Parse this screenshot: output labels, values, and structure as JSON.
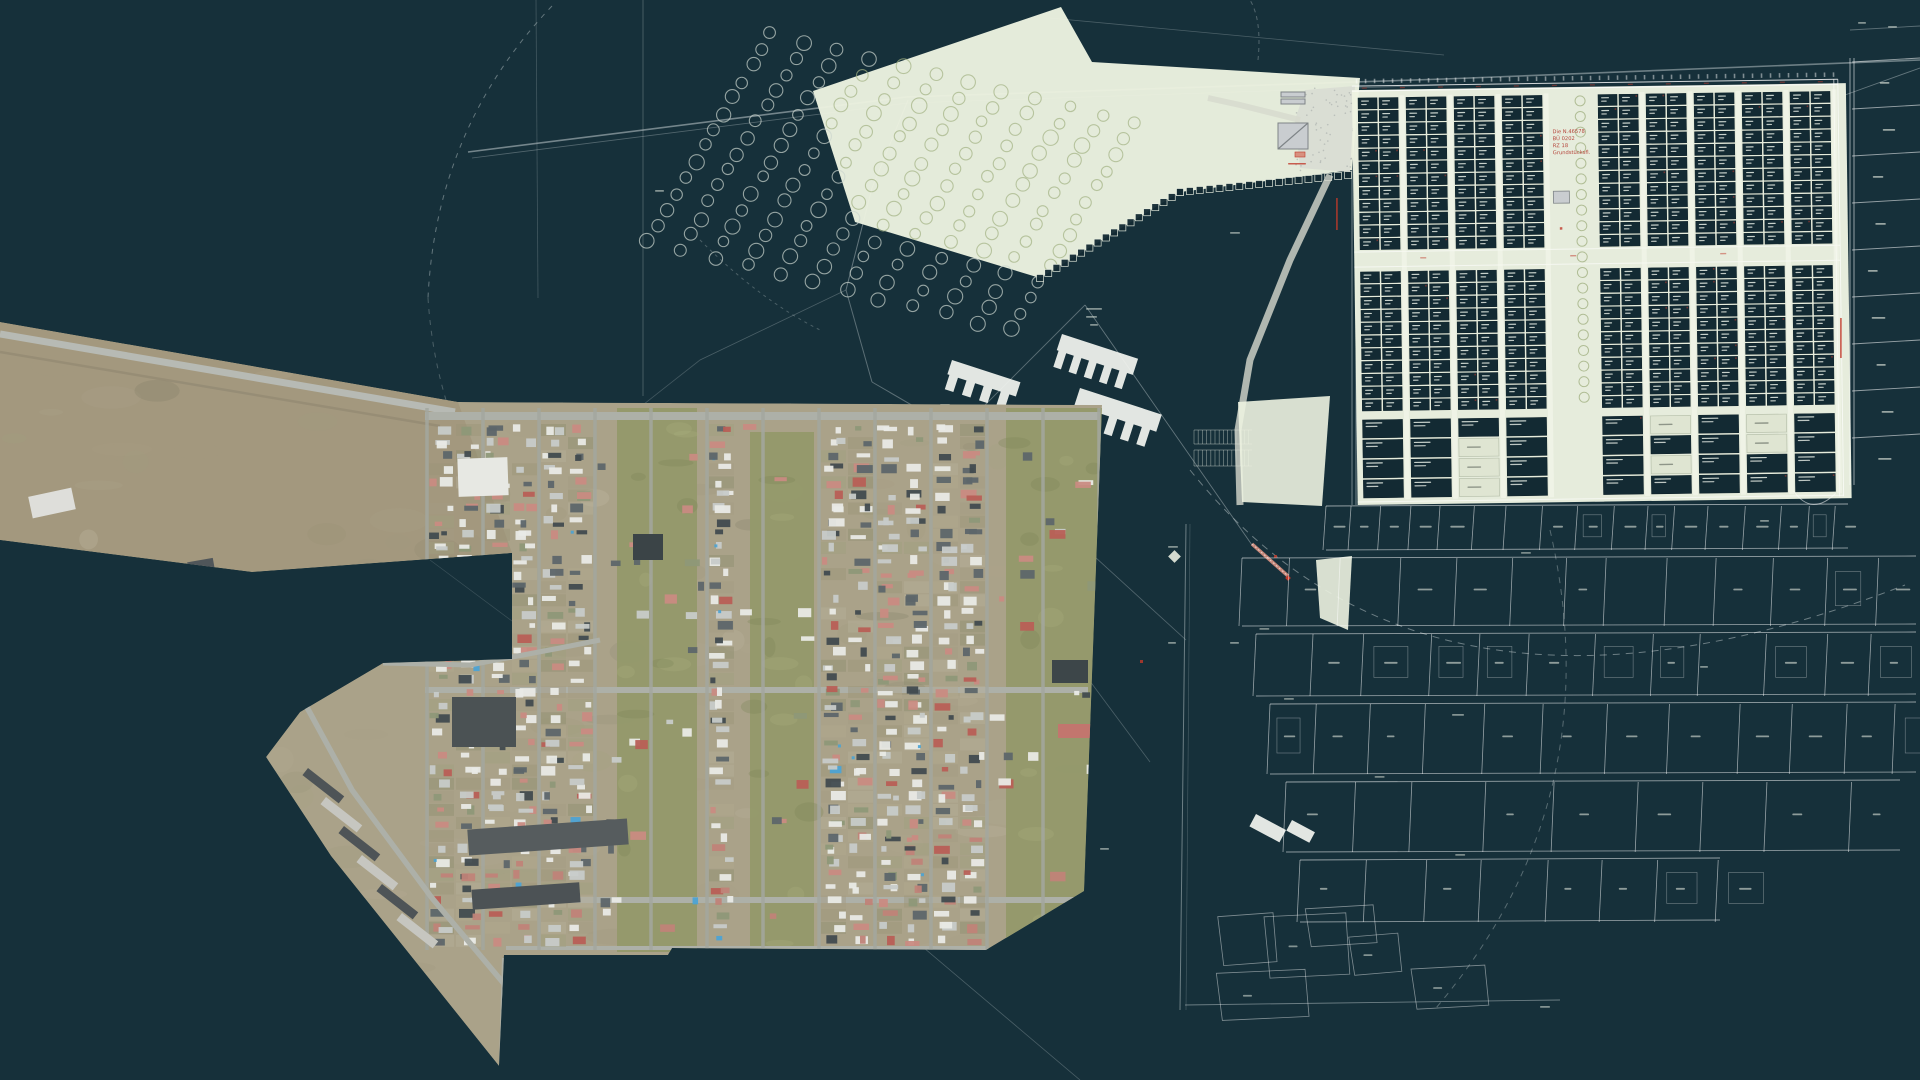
{
  "canvas": {
    "width": 1920,
    "height": 1080,
    "background": "#16303a"
  },
  "rng_seed": 1337,
  "orthophoto": {
    "outline": [
      [
        0,
        322
      ],
      [
        458,
        402
      ],
      [
        1102,
        405
      ],
      [
        1084,
        891
      ],
      [
        986,
        950
      ],
      [
        672,
        948
      ],
      [
        668,
        955
      ],
      [
        540,
        955
      ],
      [
        504,
        955
      ],
      [
        499,
        1066
      ],
      [
        331,
        856
      ],
      [
        266,
        757
      ],
      [
        300,
        712
      ],
      [
        383,
        663
      ],
      [
        512,
        659
      ],
      [
        512,
        553
      ],
      [
        252,
        572
      ],
      [
        0,
        540
      ]
    ],
    "strip": [
      [
        0,
        322
      ],
      [
        458,
        402
      ],
      [
        512,
        553
      ],
      [
        252,
        572
      ],
      [
        0,
        540
      ]
    ],
    "base_color": "#aaa289",
    "strip_color": "#a3987e",
    "ground_tints": [
      "#a59c82",
      "#b1a88f",
      "#9b9478",
      "#8f8e6e",
      "#b6af99",
      "#a0a07f"
    ],
    "mottle_dark": "#6f6d58",
    "mottle_light": "#cfc9b2",
    "green_color": "#93996a",
    "green_dark": "#7c8355",
    "green_bands": [
      [
        617,
        408,
        80,
        544
      ],
      [
        750,
        432,
        64,
        520
      ],
      [
        1006,
        408,
        96,
        544
      ]
    ],
    "road_color": "#adb0a8",
    "roads_h": [
      [
        425,
        416,
        1100,
        416,
        8
      ],
      [
        425,
        690,
        1088,
        690,
        6
      ],
      [
        470,
        900,
        1082,
        900,
        6
      ],
      [
        506,
        948,
        986,
        948,
        4
      ]
    ],
    "strip_road": [
      [
        0,
        334,
        455,
        412,
        7
      ],
      [
        0,
        352,
        440,
        426,
        2.5
      ]
    ],
    "lanes": {
      "x0": 427,
      "step": 56,
      "count": 13,
      "y0": 408,
      "y1": 950,
      "w": 3.5,
      "color": "#a4a79f"
    },
    "shed_palette": [
      [
        "#e9eae6",
        26
      ],
      [
        "#c7cbc9",
        18
      ],
      [
        "#5d666a",
        16
      ],
      [
        "#414b4f",
        10
      ],
      [
        "#c98b82",
        12
      ],
      [
        "#b85f56",
        5
      ],
      [
        "#8e9878",
        6
      ],
      [
        "#4da3d4",
        2
      ],
      [
        "none",
        5
      ]
    ],
    "accent_blue": "#4aa3d4",
    "red_boost": "#c08378",
    "buildings": [
      [
        458,
        458,
        50,
        38,
        "#e7e8e3",
        -2
      ],
      [
        452,
        697,
        64,
        50,
        "#4b5254",
        0
      ],
      [
        633,
        534,
        30,
        26,
        "#3b4447",
        0
      ],
      [
        1052,
        660,
        36,
        23,
        "#3d4649",
        0
      ],
      [
        468,
        824,
        160,
        26,
        "#565c5e",
        -4
      ],
      [
        472,
        886,
        108,
        20,
        "#4c5255",
        -4
      ],
      [
        1058,
        724,
        34,
        14,
        "#c2766e",
        0
      ],
      [
        30,
        492,
        44,
        22,
        "#dededa",
        -12
      ],
      [
        188,
        560,
        26,
        12,
        "#50565a",
        -10
      ]
    ],
    "arm_road": [
      [
        303,
        700
      ],
      [
        352,
        790
      ],
      [
        432,
        898
      ],
      [
        505,
        985
      ],
      [
        503,
        1060
      ]
    ],
    "connector_road": [
      [
        383,
        663
      ],
      [
        470,
        665
      ],
      [
        560,
        648
      ],
      [
        600,
        640
      ]
    ],
    "wedge_road": [
      [
        504,
        958
      ],
      [
        501,
        1064
      ]
    ],
    "garages": {
      "rows": [
        [
          308,
          768
        ],
        [
          326,
          797
        ],
        [
          344,
          826
        ],
        [
          362,
          855
        ],
        [
          382,
          884
        ],
        [
          402,
          913
        ]
      ],
      "w": 46,
      "h": 9,
      "rot": 38,
      "colors": [
        "#4e5457",
        "#c6c6c0"
      ]
    }
  },
  "plan": {
    "line_color": "#c2ccce",
    "pale_color": "#edf3e1",
    "cell_color": "#132a33",
    "cell_stroke": "#0c1f27",
    "cell_label_color": "#e8eee6",
    "gray_building": "#c9cdd0",
    "gray_building_stroke": "#7e8487",
    "road_fill": "#d7dace",
    "red": "#c0392b",
    "red_soft": "#d8907f",
    "white_fill": "#f2f4ef",
    "label_white": "#dfe5da",
    "tree_stroke_dark": "#ccd5cf",
    "tree_stroke_pale": "#a2b283",
    "faint_lines": [
      [
        468,
        152,
        906,
        97,
        1.6,
        0.55
      ],
      [
        472,
        158,
        908,
        103,
        0.8,
        0.35
      ],
      [
        906,
        97,
        1444,
        79,
        1.6,
        0.5
      ],
      [
        1444,
        79,
        1920,
        60,
        1.6,
        0.5
      ],
      [
        908,
        103,
        1444,
        85,
        0.8,
        0.3
      ],
      [
        643,
        0,
        643,
        396,
        0.8,
        0.35
      ],
      [
        536,
        0,
        538,
        298,
        0.8,
        0.25
      ],
      [
        908,
        100,
        872,
        188,
        1,
        0.45
      ],
      [
        872,
        188,
        846,
        290,
        1,
        0.45
      ],
      [
        846,
        290,
        872,
        382,
        1,
        0.4
      ],
      [
        872,
        382,
        958,
        432,
        1,
        0.4
      ],
      [
        846,
        290,
        700,
        360,
        0.8,
        0.3
      ],
      [
        700,
        360,
        560,
        470,
        0.8,
        0.25
      ],
      [
        958,
        432,
        1085,
        305,
        0.9,
        0.4
      ],
      [
        1085,
        305,
        1252,
        545,
        0.9,
        0.45
      ],
      [
        958,
        432,
        1186,
        640,
        0.8,
        0.35
      ],
      [
        905,
        432,
        1150,
        762,
        0.8,
        0.3
      ],
      [
        560,
        640,
        1080,
        1080,
        0.8,
        0.3
      ],
      [
        620,
        598,
        764,
        878,
        0.7,
        0.25
      ],
      [
        430,
        560,
        618,
        700,
        0.7,
        0.2
      ],
      [
        1050,
        18,
        1444,
        55,
        0.8,
        0.3
      ],
      [
        1850,
        30,
        1920,
        26,
        0.9,
        0.4
      ],
      [
        1845,
        95,
        1920,
        68,
        0.9,
        0.45
      ],
      [
        1186,
        524,
        1180,
        1010,
        1,
        0.5
      ],
      [
        1190,
        524,
        1186,
        1010,
        0.6,
        0.3
      ],
      [
        1352,
        88,
        1352,
        505,
        0.9,
        0.6
      ],
      [
        1356,
        88,
        1356,
        505,
        0.9,
        0.6
      ],
      [
        1185,
        1005,
        1560,
        1000,
        0.9,
        0.5
      ]
    ],
    "dashed_paths": [
      [
        "M552,6 Q436,128 428,298",
        0.45,
        "5 6"
      ],
      [
        "M428,298 Q436,420 500,512",
        0.3,
        "5 6"
      ],
      [
        "M1190,470 Q1430,770 1905,585",
        0.5,
        "7 6"
      ],
      [
        "M1550,530 Q1612,800 1436,1008",
        0.38,
        "6 6"
      ],
      [
        "M700,240 Q760,300 820,330",
        0.3,
        "3 4"
      ],
      [
        "M1258,60 Q1262,20 1250,0",
        0.35,
        "4 4"
      ]
    ],
    "orchard": [
      [
        813,
        91
      ],
      [
        1061,
        7
      ],
      [
        1092,
        62
      ],
      [
        1360,
        78
      ],
      [
        1352,
        170
      ],
      [
        1180,
        192
      ],
      [
        1040,
        278
      ],
      [
        855,
        222
      ]
    ],
    "tree_rows": {
      "count": 12,
      "sx": 648,
      "sy": 242,
      "row_dx": 33,
      "row_dy": 8,
      "step_dx": 9.5,
      "step_dy": -16,
      "steps": 14,
      "r": 6.5
    },
    "hedge_row": {
      "path": [
        [
          1040,
          278
        ],
        [
          1180,
          192
        ],
        [
          1348,
          175
        ]
      ],
      "size": 7,
      "step": 9.5
    },
    "plaza": {
      "poly": [
        [
          1305,
          90
        ],
        [
          1355,
          86
        ],
        [
          1350,
          172
        ],
        [
          1300,
          168
        ],
        [
          1295,
          120
        ]
      ],
      "walk": [
        [
          1300,
          120
        ],
        [
          1240,
          105
        ],
        [
          1208,
          98
        ]
      ],
      "buildings": [
        [
          1278,
          123,
          30,
          26
        ],
        [
          1281,
          92,
          24,
          5
        ],
        [
          1281,
          99,
          24,
          5
        ]
      ],
      "red_rect": [
        1295,
        152,
        10,
        5
      ],
      "red_label": [
        1288,
        163,
        18
      ],
      "access_road": [
        [
          1330,
          175
        ],
        [
          1290,
          260
        ],
        [
          1250,
          360
        ],
        [
          1238,
          430
        ],
        [
          1240,
          505
        ]
      ]
    },
    "grid": {
      "x0": 1358,
      "y0": 98,
      "groups": 10,
      "group_w": 48,
      "cell_w": 19,
      "cell_h": 11,
      "gap": 2,
      "row_step": 12.8,
      "upper_rows": 12,
      "mid_y": 252,
      "lower_y": 272,
      "lower_rows": 11,
      "bottom_y": 420,
      "bottom_rows": 4,
      "bottom_h": 20,
      "corridor_group": 4,
      "rot": -0.8,
      "bg_x": 1352,
      "bg_y": 90,
      "bg_w": 494,
      "bg_h": 415,
      "annotation": [
        "Die N.46578",
        "BÜ 0202",
        "RZ 18",
        "Grundstücksfl."
      ],
      "annotation_color": "#b5443a"
    },
    "red_vlabels": [
      [
        1336,
        198,
        32
      ],
      [
        1840,
        318,
        40
      ]
    ],
    "red_dots": [
      [
        1274,
        555
      ],
      [
        1140,
        660
      ]
    ],
    "right_parcels": {
      "x0": 1852,
      "x1": 1920,
      "y0": 62,
      "rows": 9,
      "h": 47
    },
    "lower_bands": [
      [
        506,
        44,
        1326,
        1848,
        17
      ],
      [
        558,
        68,
        1242,
        1916,
        13
      ],
      [
        634,
        62,
        1256,
        1916,
        12
      ],
      [
        704,
        70,
        1270,
        1916,
        11
      ],
      [
        782,
        70,
        1286,
        1900,
        9
      ],
      [
        860,
        62,
        1300,
        1720,
        6
      ]
    ],
    "white_buildings": [
      [
        1062,
        334,
        80,
        34,
        5,
        18
      ],
      [
        1080,
        388,
        86,
        36,
        5,
        18
      ],
      [
        952,
        360,
        72,
        30,
        4,
        18
      ],
      [
        1256,
        814,
        34,
        14,
        0,
        28
      ],
      [
        1292,
        820,
        26,
        12,
        0,
        28
      ]
    ],
    "pale_patches": [
      [
        [
          1238,
          402
        ],
        [
          1330,
          396
        ],
        [
          1322,
          506
        ],
        [
          1242,
          502
        ]
      ],
      [
        [
          1316,
          560
        ],
        [
          1352,
          556
        ],
        [
          1348,
          630
        ],
        [
          1320,
          618
        ]
      ]
    ],
    "parking": {
      "x0": 1194,
      "x1": 1252,
      "rows": [
        [
          430,
          444
        ],
        [
          450,
          466
        ]
      ]
    },
    "pink_bar": [
      1252,
      544,
      1288,
      576
    ],
    "white_diamond": [
      1170,
      552,
      9
    ],
    "labels": [
      [
        1086,
        308,
        16
      ],
      [
        1086,
        316,
        11
      ],
      [
        1090,
        324,
        8
      ],
      [
        940,
        404,
        10
      ],
      [
        1046,
        468,
        9
      ],
      [
        1168,
        546,
        10
      ],
      [
        1230,
        642,
        9
      ],
      [
        1168,
        642,
        8
      ],
      [
        1452,
        714,
        12
      ],
      [
        1540,
        1006,
        10
      ],
      [
        1100,
        848,
        9
      ],
      [
        655,
        190,
        9
      ],
      [
        1858,
        22,
        8
      ],
      [
        1888,
        26,
        9
      ],
      [
        1760,
        520,
        9
      ],
      [
        1700,
        666,
        8
      ],
      [
        1230,
        232,
        10
      ]
    ]
  }
}
